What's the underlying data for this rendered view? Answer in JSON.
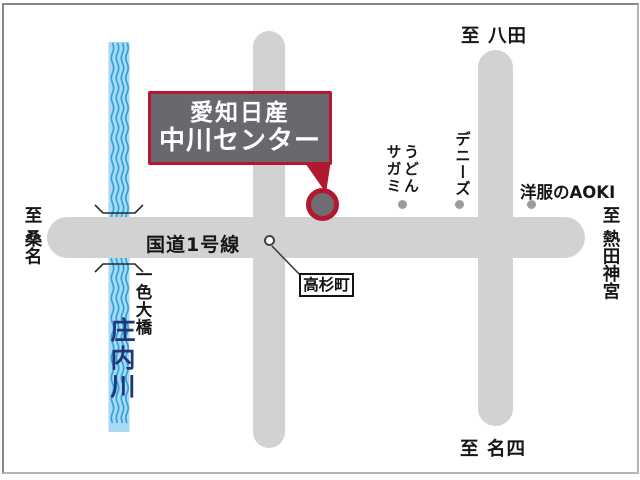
{
  "destination_box": {
    "line1": "愛知日産",
    "line2": "中川センター"
  },
  "roads": {
    "route1_label": "国道1号線"
  },
  "directions": {
    "top": "至 八田",
    "left": "至 桑名",
    "right": "至 熱田神宮",
    "bottom": "至 名四"
  },
  "river": {
    "name": "庄内川",
    "bridge_name": "一色大橋"
  },
  "poi": {
    "udon_sagami": "うどん\nサガミ",
    "dennys": "デニーズ",
    "aoki": "洋服のAOKI",
    "intersection": "高杉町"
  },
  "colors": {
    "road_gray": "#d3d2d3",
    "accent_red": "#b2182f",
    "box_fill_gray": "#6a676e",
    "river_fill": "#a9daf5",
    "river_wave": "#2fa2db",
    "river_text": "#21367a",
    "poi_dot_gray": "#9c9c9c",
    "frame_gray": "#868686"
  }
}
